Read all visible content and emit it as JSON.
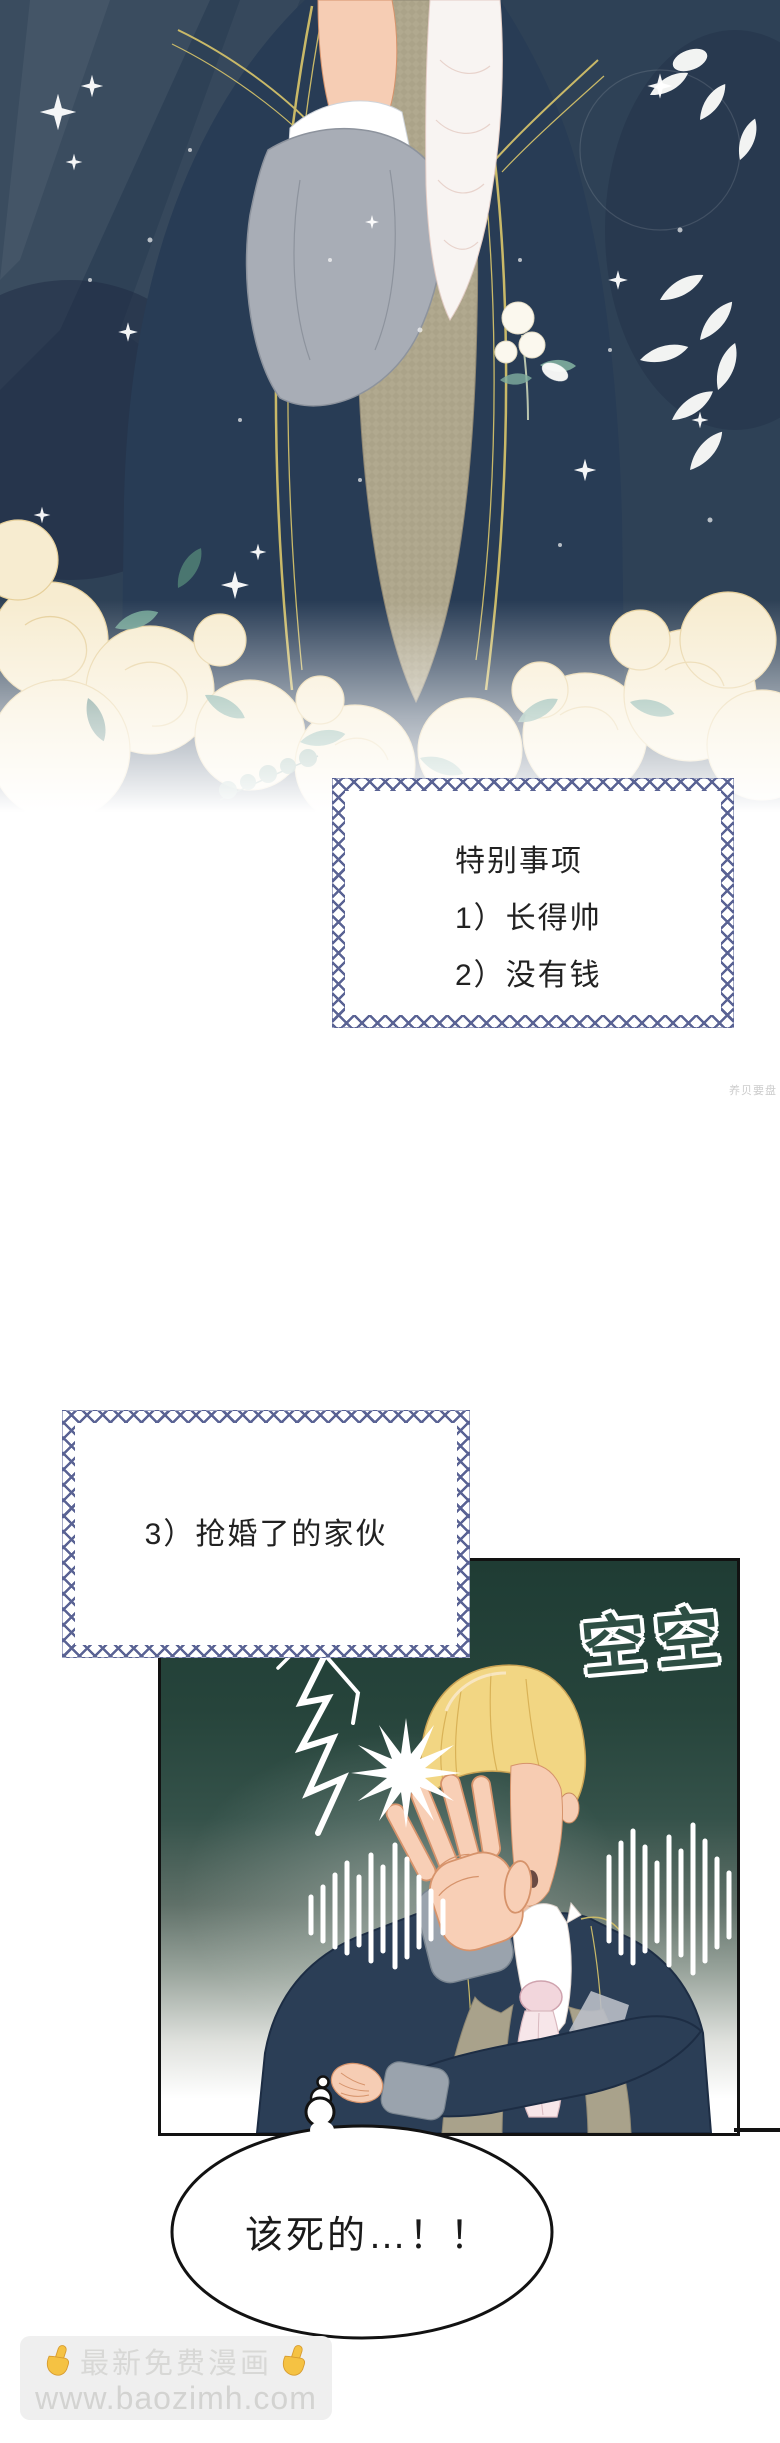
{
  "page": {
    "width": 780,
    "height": 2443,
    "background": "#ffffff"
  },
  "colors": {
    "illustration_bg": "#2e4156",
    "jacket_navy": "#2b3e56",
    "gold_piping": "#c9b968",
    "vest_tan": "#b1a98f",
    "sleeve_grey": "#a8adb6",
    "skin": "#f6cdb4",
    "hair_blonde": "#f2d683",
    "cravat_pink": "#f2d6dc",
    "rose_cream": "#f6ecd0",
    "leaf_teal": "#6fa294",
    "ornate_border": "#5a6394",
    "panel_green_top": "#1f3c34",
    "sfx_green": "#2e4f44",
    "ink": "#121212",
    "watermark_grey": "#d6d6d6",
    "finger_yellow": "#f5c243"
  },
  "note_box_1": {
    "title": "特别事项",
    "item_1": "1）长得帅",
    "item_2": "2）没有钱"
  },
  "note_box_2": {
    "item_3": "3）抢婚了的家伙"
  },
  "sfx": {
    "text": "空空"
  },
  "speech_bubble": {
    "text": "该死的…！！"
  },
  "side_watermark": {
    "text": "养贝要盘"
  },
  "footer_watermark": {
    "line_1": "最新免费漫画",
    "line_2": "www.baozimh.com"
  }
}
